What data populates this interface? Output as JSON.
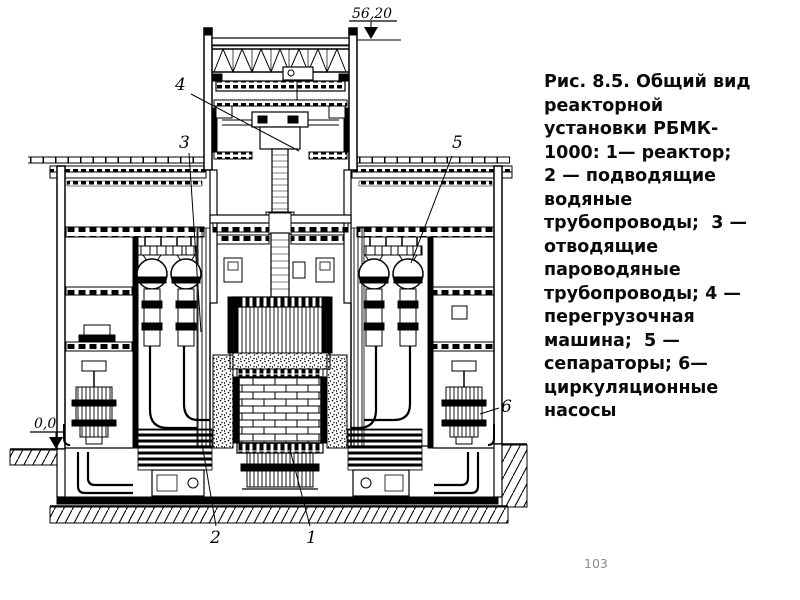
{
  "caption": {
    "text": "Рис. 8.5. Общий вид реакторной установки РБМК-1000: 1— реактор; 2 — подводящие водяные трубопроводы; 3 — отводящие пароводяные трубопроводы; 4 — перегрузочная машина; 5 — сепараторы; 6— циркуляционные насосы",
    "lines": [
      "Рис. 8.5. Общий вид",
      "реакторной",
      "установки РБМК-",
      "1000: 1— реактор;",
      "2 — подводящие",
      "водяные",
      "трубопроводы;  3 —",
      "отводящие",
      "пароводяные",
      "трубопроводы; 4 —",
      "перегрузочная",
      "машина;  5 —",
      "сепараторы; 6—",
      "циркуляционные",
      "насосы"
    ]
  },
  "figure": {
    "elevation_roof": "56,20",
    "elevation_ground": "0,0",
    "callout_1": "1",
    "callout_2": "2",
    "callout_3": "3",
    "callout_4": "4",
    "callout_5": "5",
    "callout_6": "6"
  },
  "footer": {
    "page_number": "103"
  },
  "colors": {
    "background": "#ffffff",
    "ink": "#000000",
    "page_number_gray": "#8b8b8b"
  }
}
